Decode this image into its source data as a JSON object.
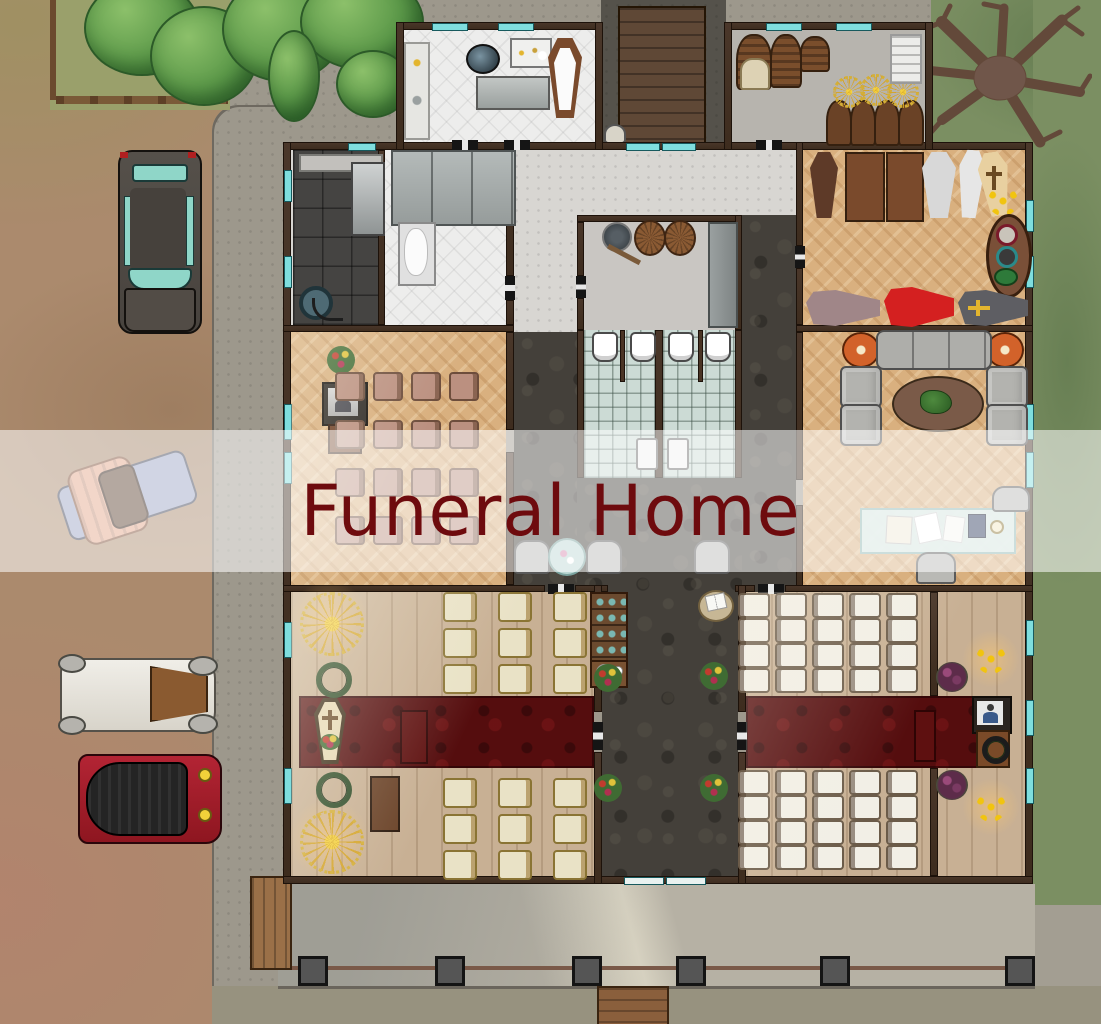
{
  "banner": {
    "title": "Funeral Home"
  },
  "palette": {
    "title": "#6e0b0e",
    "banner_bg": "rgba(255,255,255,0.55)",
    "dirt": "#ab8a6d",
    "grass": "#7b8f62",
    "concrete": "#9d988c",
    "concrete_dark": "#55524b",
    "porch": "#b6b1a4",
    "wall": "#3d2c1e",
    "deck": "#5f4836",
    "hall_floor": "#d8d6d2",
    "white_tile": "#ededec",
    "dark_tile": "#454442",
    "herringbone": "#d9b07f",
    "plank": "#c8b094",
    "carpet_dark": "#44403a",
    "carpet_red": "#550d0e",
    "bath_tile": "#ccdbd5",
    "window": "#7fdede",
    "gold": "#e3b52e",
    "coffin_red": "#d42020"
  },
  "features": {
    "outdoor": [
      "dirt-road",
      "concrete-apron",
      "lawn",
      "garden-with-trees",
      "dead-tree",
      "front-porch"
    ],
    "vehicles": [
      "hearse",
      "antique-car",
      "white-vintage-car",
      "red-vintage-car"
    ],
    "rooms": [
      "embalming-room",
      "storage-room",
      "rear-hall",
      "wash-room",
      "morgue",
      "supply-closet",
      "restrooms",
      "casket-showroom",
      "visitation-room",
      "lounge",
      "hallway",
      "chapel-west",
      "chapel-east",
      "entry-lobby",
      "front-porch"
    ]
  },
  "seating": {
    "visitation": {
      "rows": 4,
      "cols": 4,
      "x0": 335,
      "y0": 372,
      "dx": 38,
      "dy": 48,
      "w": 26,
      "h": 25,
      "style": "chair-mauve",
      "item_name": "visitation-chair"
    },
    "chapel_west_top": {
      "rows": 3,
      "cols": 3,
      "x0": 443,
      "y0": 592,
      "dx": 55,
      "dy": 36,
      "w": 30,
      "h": 26,
      "style": "chair-cream",
      "item_name": "chapel-chair"
    },
    "chapel_west_bottom": {
      "rows": 3,
      "cols": 3,
      "x0": 443,
      "y0": 778,
      "dx": 55,
      "dy": 36,
      "w": 30,
      "h": 26,
      "style": "chair-cream",
      "item_name": "chapel-chair"
    },
    "chapel_east_top": {
      "rows": 4,
      "cols": 5,
      "x0": 738,
      "y0": 593,
      "dx": 37,
      "dy": 25,
      "w": 28,
      "h": 21,
      "style": "chair-white",
      "item_name": "chapel-chair"
    },
    "chapel_east_bottom": {
      "rows": 4,
      "cols": 5,
      "x0": 738,
      "y0": 770,
      "dx": 37,
      "dy": 25,
      "w": 28,
      "h": 21,
      "style": "chair-white",
      "item_name": "chapel-chair"
    }
  },
  "porch": {
    "pillar_xs": [
      298,
      435,
      572,
      676,
      820,
      1005
    ],
    "pillar_y": 956,
    "pillar_size": 24
  }
}
